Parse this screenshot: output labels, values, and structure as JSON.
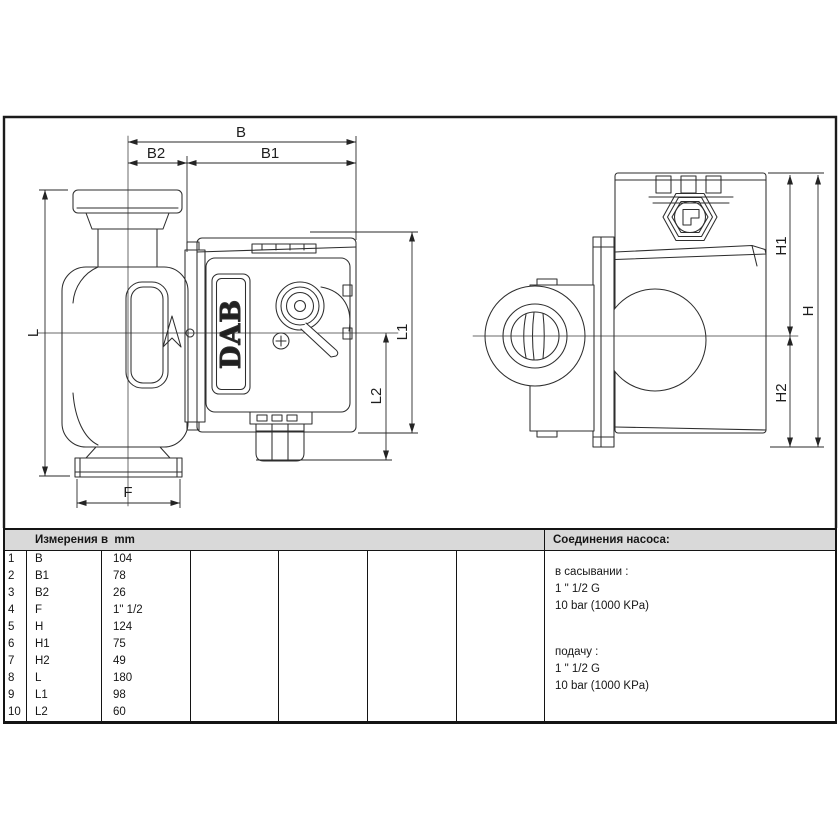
{
  "meta": {
    "background_color": "#ffffff",
    "line_color": "#2e2e2e",
    "table_header_bg": "#d9d9d9"
  },
  "drawing": {
    "logo": "DAB",
    "dims": {
      "B": "B",
      "B1": "B1",
      "B2": "B2",
      "F": "F",
      "L": "L",
      "L1": "L1",
      "L2": "L2",
      "H": "H",
      "H1": "H1",
      "H2": "H2"
    }
  },
  "table": {
    "header": "Измерения в  mm",
    "rows": [
      {
        "num": "1",
        "label": "B",
        "value": "104"
      },
      {
        "num": "2",
        "label": "B1",
        "value": "78"
      },
      {
        "num": "3",
        "label": "B2",
        "value": "26"
      },
      {
        "num": "4",
        "label": "F",
        "value": "1\" 1/2"
      },
      {
        "num": "5",
        "label": "H",
        "value": "124"
      },
      {
        "num": "6",
        "label": "H1",
        "value": "75"
      },
      {
        "num": "7",
        "label": "H2",
        "value": "49"
      },
      {
        "num": "8",
        "label": "L",
        "value": "180"
      },
      {
        "num": "9",
        "label": "L1",
        "value": "98"
      },
      {
        "num": "10",
        "label": "L2",
        "value": "60"
      }
    ]
  },
  "connections": {
    "header": "Соединения насоса:",
    "suction": {
      "label": "в сасывании :",
      "size": "1 \" 1/2 G",
      "pressure": "10 bar (1000 KPa)"
    },
    "delivery": {
      "label": "подачу :",
      "size": "1 \" 1/2 G",
      "pressure": "10 bar (1000 KPa)"
    }
  }
}
